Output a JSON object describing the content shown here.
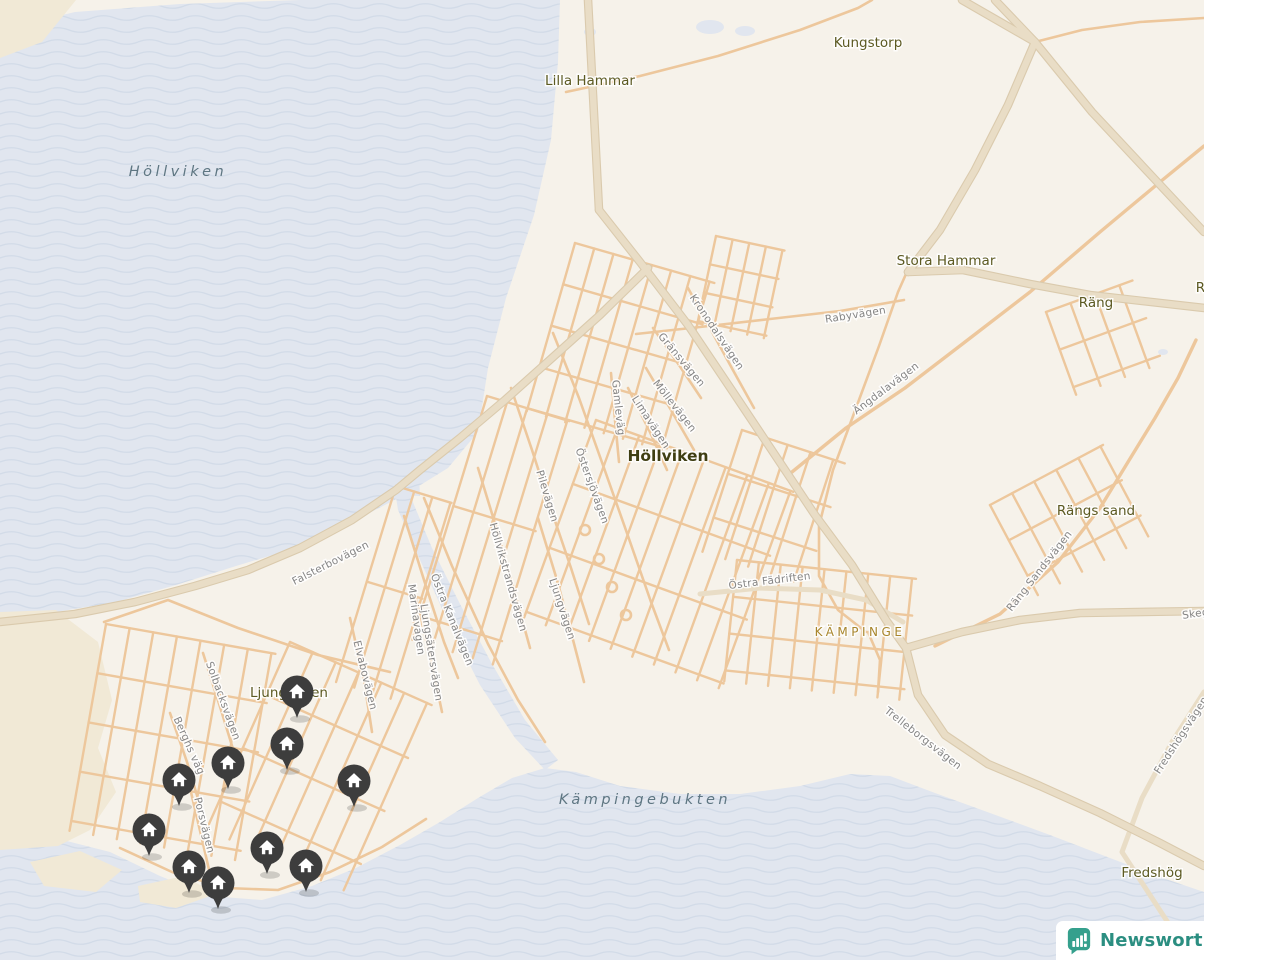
{
  "logo": {
    "text": "Newsworthy"
  },
  "map": {
    "colors": {
      "land": "#f6f2ea",
      "water_base": "#e1e6ef",
      "wave_line": "#d2dbe8",
      "sand": "#f1e9d6",
      "road_minor": "#edc79c",
      "road_major_fill": "#e9ddc6",
      "road_major_casing": "#dacaad",
      "street_label": "#858585",
      "place_label": "#5c5a22",
      "town_label": "#3f3e12",
      "district_label": "#a8862c",
      "water_label": "#5e7682",
      "pin": "#3d3d3d",
      "pin_icon": "#ffffff",
      "logo_teal": "#35a08d"
    },
    "water_labels": [
      {
        "text": "Höllviken",
        "x": 178,
        "y": 176
      },
      {
        "text": "Kämpingebukten",
        "x": 645,
        "y": 804
      }
    ],
    "place_labels": [
      {
        "text": "Kungstorp",
        "x": 868,
        "y": 47
      },
      {
        "text": "Lilla Hammar",
        "x": 590,
        "y": 85
      },
      {
        "text": "Stora Hammar",
        "x": 946,
        "y": 265
      },
      {
        "text": "Räng",
        "x": 1096,
        "y": 307
      },
      {
        "text": "Räng",
        "x": 1213,
        "y": 292
      },
      {
        "text": "Rängs sand",
        "x": 1096,
        "y": 515
      },
      {
        "text": "Fredshög",
        "x": 1152,
        "y": 877
      },
      {
        "text": "Ljunghusen",
        "x": 289,
        "y": 697
      }
    ],
    "town_label": {
      "text": "Höllviken",
      "x": 668,
      "y": 461
    },
    "district_label": {
      "text": "KÄMPINGE",
      "x": 860,
      "y": 636
    },
    "street_labels": [
      {
        "text": "Rabyvägen",
        "x": 856,
        "y": 318,
        "rot": -9
      },
      {
        "text": "Kronodalsvägen",
        "x": 714,
        "y": 334,
        "rot": 56
      },
      {
        "text": "Gränsvägen",
        "x": 679,
        "y": 362,
        "rot": 50
      },
      {
        "text": "Möllevägen",
        "x": 672,
        "y": 408,
        "rot": 52
      },
      {
        "text": "Gamleväg",
        "x": 615,
        "y": 408,
        "rot": 84
      },
      {
        "text": "Limavägen",
        "x": 648,
        "y": 424,
        "rot": 57
      },
      {
        "text": "Ängdalavägen",
        "x": 888,
        "y": 391,
        "rot": -37
      },
      {
        "text": "Östersjövägen",
        "x": 589,
        "y": 487,
        "rot": 70
      },
      {
        "text": "Pilevägen",
        "x": 544,
        "y": 497,
        "rot": 73
      },
      {
        "text": "Höllvikstrandsvägen",
        "x": 505,
        "y": 578,
        "rot": 74
      },
      {
        "text": "Ljungvägen",
        "x": 559,
        "y": 610,
        "rot": 72
      },
      {
        "text": "Falsterbovägen",
        "x": 332,
        "y": 566,
        "rot": -27
      },
      {
        "text": "Marinavägen",
        "x": 413,
        "y": 620,
        "rot": 82
      },
      {
        "text": "Östra Kanalvägen",
        "x": 449,
        "y": 621,
        "rot": 68
      },
      {
        "text": "Ljungsätersvägen",
        "x": 428,
        "y": 653,
        "rot": 81
      },
      {
        "text": "Elvabovägen",
        "x": 362,
        "y": 676,
        "rot": 76
      },
      {
        "text": "Östra Fädriften",
        "x": 770,
        "y": 584,
        "rot": -7
      },
      {
        "text": "Räng Sandsvägen",
        "x": 1042,
        "y": 573,
        "rot": -52
      },
      {
        "text": "Solbacksvägen",
        "x": 220,
        "y": 702,
        "rot": 70
      },
      {
        "text": "Berghs väg",
        "x": 186,
        "y": 747,
        "rot": 66
      },
      {
        "text": "Porsvägen",
        "x": 201,
        "y": 826,
        "rot": 76
      },
      {
        "text": "Trelleborgsvägen",
        "x": 921,
        "y": 741,
        "rot": 38
      },
      {
        "text": "Fredshögsvägen",
        "x": 1184,
        "y": 737,
        "rot": -57
      },
      {
        "text": "Skeg",
        "x": 1196,
        "y": 617,
        "rot": -8
      }
    ],
    "pins": [
      {
        "x": 297,
        "y": 692
      },
      {
        "x": 287,
        "y": 744
      },
      {
        "x": 228,
        "y": 763
      },
      {
        "x": 179,
        "y": 780
      },
      {
        "x": 354,
        "y": 781
      },
      {
        "x": 149,
        "y": 830
      },
      {
        "x": 267,
        "y": 848
      },
      {
        "x": 189,
        "y": 867
      },
      {
        "x": 306,
        "y": 866
      },
      {
        "x": 218,
        "y": 883
      }
    ],
    "geometry": {
      "water": [
        "0,30 75,12 180,4 300,0 560,0 558,62 551,140 534,215 506,298 488,368 478,432 448,468 406,494 352,522 296,548 236,566 176,585 116,602 56,612 0,618",
        "0,845 55,838 110,852 160,876 210,896 262,900 312,886 356,868 400,845 440,822 478,798 512,778 545,768 576,772 620,786 680,794 740,794 800,786 850,774 890,776 935,793 990,813 1050,835 1110,858 1160,877 1204,892 1204,960 0,960",
        "392,472 410,470 412,500 432,548 460,604 492,664 525,720 558,760 545,770 515,738 480,685 448,622 420,560 398,510",
        "383,458 418,456 420,496 392,495"
      ],
      "ponds": [
        [
          710,
          27,
          14,
          7
        ],
        [
          745,
          31,
          10,
          5
        ],
        [
          590,
          32,
          6,
          4
        ],
        [
          1163,
          352,
          5,
          3
        ]
      ],
      "sand": [
        "0,0 76,0 42,42 0,58",
        "0,612 56,610 98,642 112,700 98,748 116,792 90,830 58,846 0,850",
        "30,862 80,851 122,870 96,892 44,886",
        "138,886 184,876 216,894 176,908 140,902"
      ],
      "roads_major": [
        "588,0 593,95 599,210",
        "599,210 640,262 688,325 733,392 775,455 815,515 852,565 886,620 906,648",
        "906,648 918,695 945,735 988,764 1040,786 1100,813 1160,843 1204,866",
        "648,268 600,315 552,358 505,400 460,438 420,470 396,490 352,520 300,548 248,570 195,586 135,602 75,614 0,622",
        "1035,42 1008,105 975,170 940,230 908,272",
        "962,0 1035,42 1092,112 1148,172 1204,232",
        "995,0 1035,42",
        "908,272 963,270 1030,284 1090,295 1204,308",
        "906,648 962,632 1020,620 1080,613 1204,611"
      ],
      "roads_medium": [
        "1204,692 1172,742 1142,798 1122,852 1148,892 1178,938 1192,960",
        "700,594 760,588 820,590 866,600 903,622"
      ],
      "roads_minor": [
        "553,333 579,398 604,468 628,536 651,602 669,650",
        "511,388 532,450 552,512 571,568 589,624",
        "478,468 497,530 514,590 530,648",
        "538,518 557,580 572,636 584,682",
        "404,516 424,580 444,642 458,678",
        "424,498 452,566 488,644 518,700 545,742",
        "416,598 431,660 442,712",
        "350,618 364,680 372,732",
        "203,653 221,710 237,762",
        "170,713 187,762 199,802",
        "190,788 201,835 210,874",
        "611,373 615,420 619,462",
        "628,388 649,430 667,470",
        "646,368 671,410 694,450",
        "653,328 679,365 701,398",
        "688,288 711,330 734,372 754,408",
        "636,334 700,327 770,319 840,311 904,300",
        "906,274 898,292 879,346 856,408 833,470 819,526 819,576 838,610 866,632",
        "566,92 640,76 718,56 800,30 858,8 872,0",
        "104,622 168,600 238,628 318,655 390,672",
        "120,848 172,872 226,888 278,890 330,872 382,847 426,819",
        "1035,42 1082,30 1140,22 1204,18",
        "868,632 880,660 878,692"
      ],
      "roads_wide_minor": [
        "792,472 846,428 905,388 965,342 1030,292 1100,232 1160,182 1204,146",
        "935,646 1000,614 1058,562 1100,508 1128,462 1155,418 1178,378 1196,340"
      ],
      "grids": [
        {
          "x": 575,
          "y": 243,
          "rot": 16,
          "v": [
            8,
            20,
            175
          ],
          "h": [
            5,
            43,
            145
          ]
        },
        {
          "x": 716,
          "y": 236,
          "rot": 12,
          "v": [
            5,
            17,
            90
          ],
          "h": [
            4,
            29,
            70
          ]
        },
        {
          "x": 596,
          "y": 420,
          "rot": 20,
          "v": [
            10,
            23,
            210
          ],
          "h": [
            4,
            68,
            210
          ]
        },
        {
          "x": 487,
          "y": 396,
          "rot": 17,
          "v": [
            5,
            21,
            255
          ],
          "h": [
            3,
            115,
            86
          ]
        },
        {
          "x": 396,
          "y": 486,
          "rot": 17,
          "v": [
            4,
            19,
            205
          ],
          "h": [
            2,
            100,
            58
          ]
        },
        {
          "x": 106,
          "y": 624,
          "rot": 10,
          "v": [
            8,
            24,
            210
          ],
          "h": [
            5,
            50,
            172
          ]
        },
        {
          "x": 290,
          "y": 642,
          "rot": 24,
          "v": [
            7,
            25,
            205
          ],
          "h": [
            4,
            58,
            155
          ]
        },
        {
          "x": 737,
          "y": 560,
          "rot": 6,
          "v": [
            9,
            22,
            122
          ],
          "h": [
            4,
            37,
            180
          ]
        },
        {
          "x": 990,
          "y": 505,
          "rot": -28,
          "v": [
            6,
            25,
            102
          ],
          "h": [
            3,
            40,
            128
          ]
        },
        {
          "x": 1046,
          "y": 312,
          "rot": -20,
          "v": [
            4,
            26,
            88
          ],
          "h": [
            3,
            40,
            92
          ]
        },
        {
          "x": 742,
          "y": 430,
          "rot": 18,
          "v": [
            5,
            24,
            128
          ],
          "h": [
            3,
            46,
            108
          ]
        }
      ],
      "lollipops": [
        [
          585,
          530
        ],
        [
          599,
          559
        ],
        [
          612,
          587
        ],
        [
          626,
          615
        ]
      ]
    }
  }
}
